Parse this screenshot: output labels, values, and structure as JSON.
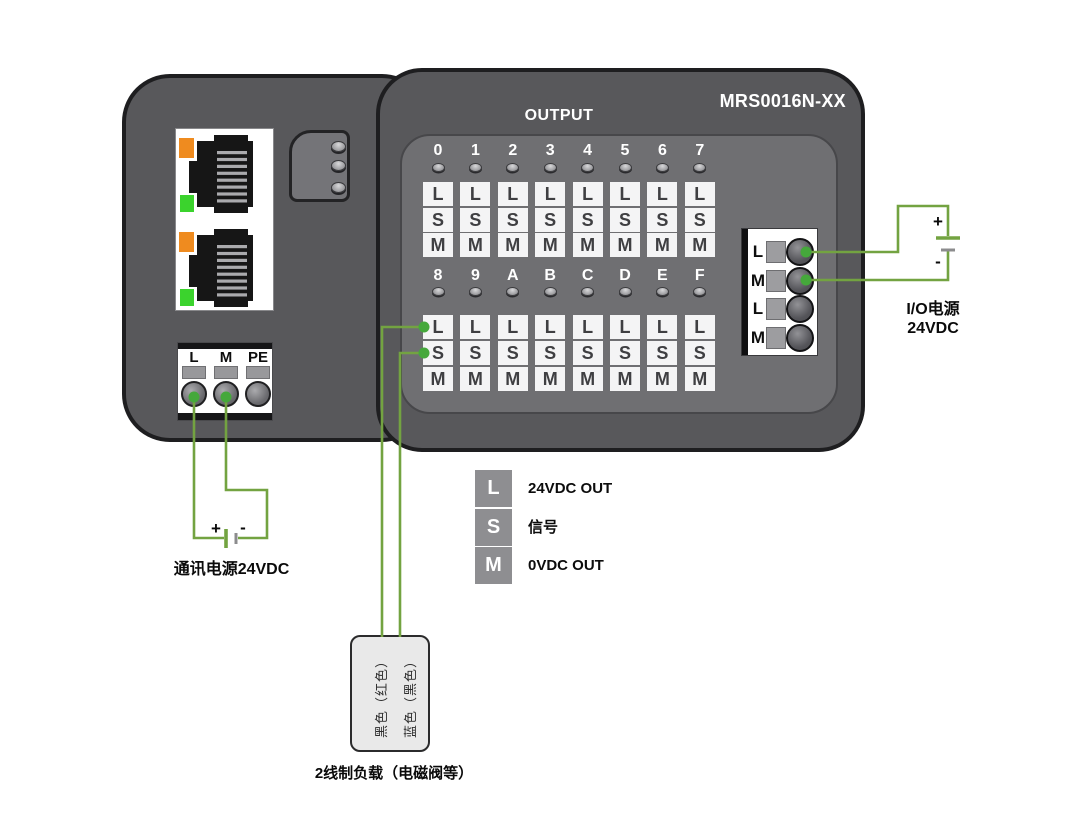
{
  "device": {
    "model": "MRS0016N-XX",
    "panel_label": "OUTPUT",
    "channel_group1": [
      "0",
      "1",
      "2",
      "3",
      "4",
      "5",
      "6",
      "7"
    ],
    "channel_group2": [
      "8",
      "9",
      "A",
      "B",
      "C",
      "D",
      "E",
      "F"
    ],
    "channel_terminals": [
      "L",
      "S",
      "M"
    ],
    "io_power_terminals": [
      "L",
      "M",
      "L",
      "M"
    ],
    "comm_power_terminals": [
      "L",
      "M",
      "PE"
    ]
  },
  "legend": {
    "items": [
      {
        "key": "L",
        "label": "24VDC OUT"
      },
      {
        "key": "S",
        "label": "信号"
      },
      {
        "key": "M",
        "label": "0VDC OUT"
      }
    ]
  },
  "annotations": {
    "io_power": {
      "line1": "I/O电源",
      "line2": "24VDC"
    },
    "comm_power": "通讯电源24VDC",
    "load_caption": "2线制负载（电磁阀等）",
    "load_wire_left": "黑色（红色）",
    "load_wire_right": "蓝色（黑色）",
    "plus": "+",
    "minus": "-"
  },
  "colors": {
    "wire_green": "#73a341",
    "dot_green": "#45a83b",
    "battery_plate_gray": "#8c8c8e",
    "led_orange": "#ef8b1f",
    "led_green": "#3bd32d",
    "module_gray": "#58585b",
    "panel_gray": "#6f6f72"
  }
}
